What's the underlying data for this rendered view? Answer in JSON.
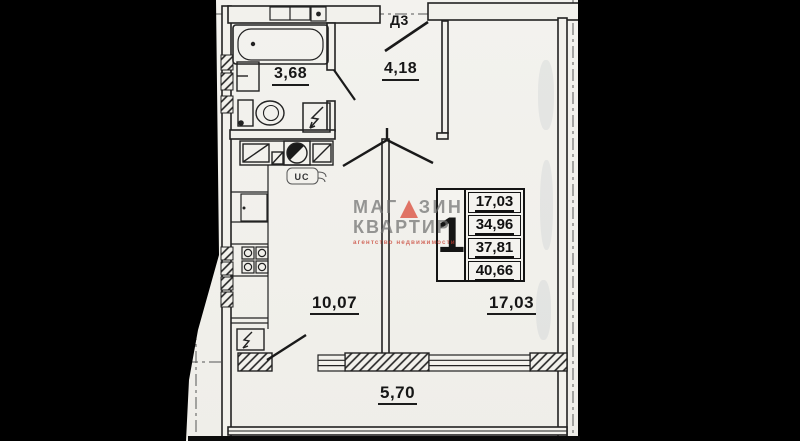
{
  "plan": {
    "entry_door_label": "Д3",
    "uc_label": "UC",
    "rooms": [
      {
        "id": "bathroom",
        "area": "3,68"
      },
      {
        "id": "hallway",
        "area": "4,18"
      },
      {
        "id": "kitchen",
        "area": "10,07"
      },
      {
        "id": "living-room",
        "area": "17,03"
      },
      {
        "id": "balcony",
        "area": "5,70"
      }
    ],
    "area_table": {
      "rooms_count": "1",
      "areas": [
        "17,03",
        "34,96",
        "37,81",
        "40,66"
      ]
    },
    "watermark": {
      "line1_left": "МАГ",
      "line1_right": "ЗИН",
      "line2": "КВАРТИР",
      "line3": "агентство недвижимости"
    },
    "colors": {
      "paper": "#f2f1ec",
      "ink": "#222222",
      "watermark_gray": "#8e8e8e",
      "watermark_red": "#db4d3e",
      "background": "#000000"
    }
  }
}
